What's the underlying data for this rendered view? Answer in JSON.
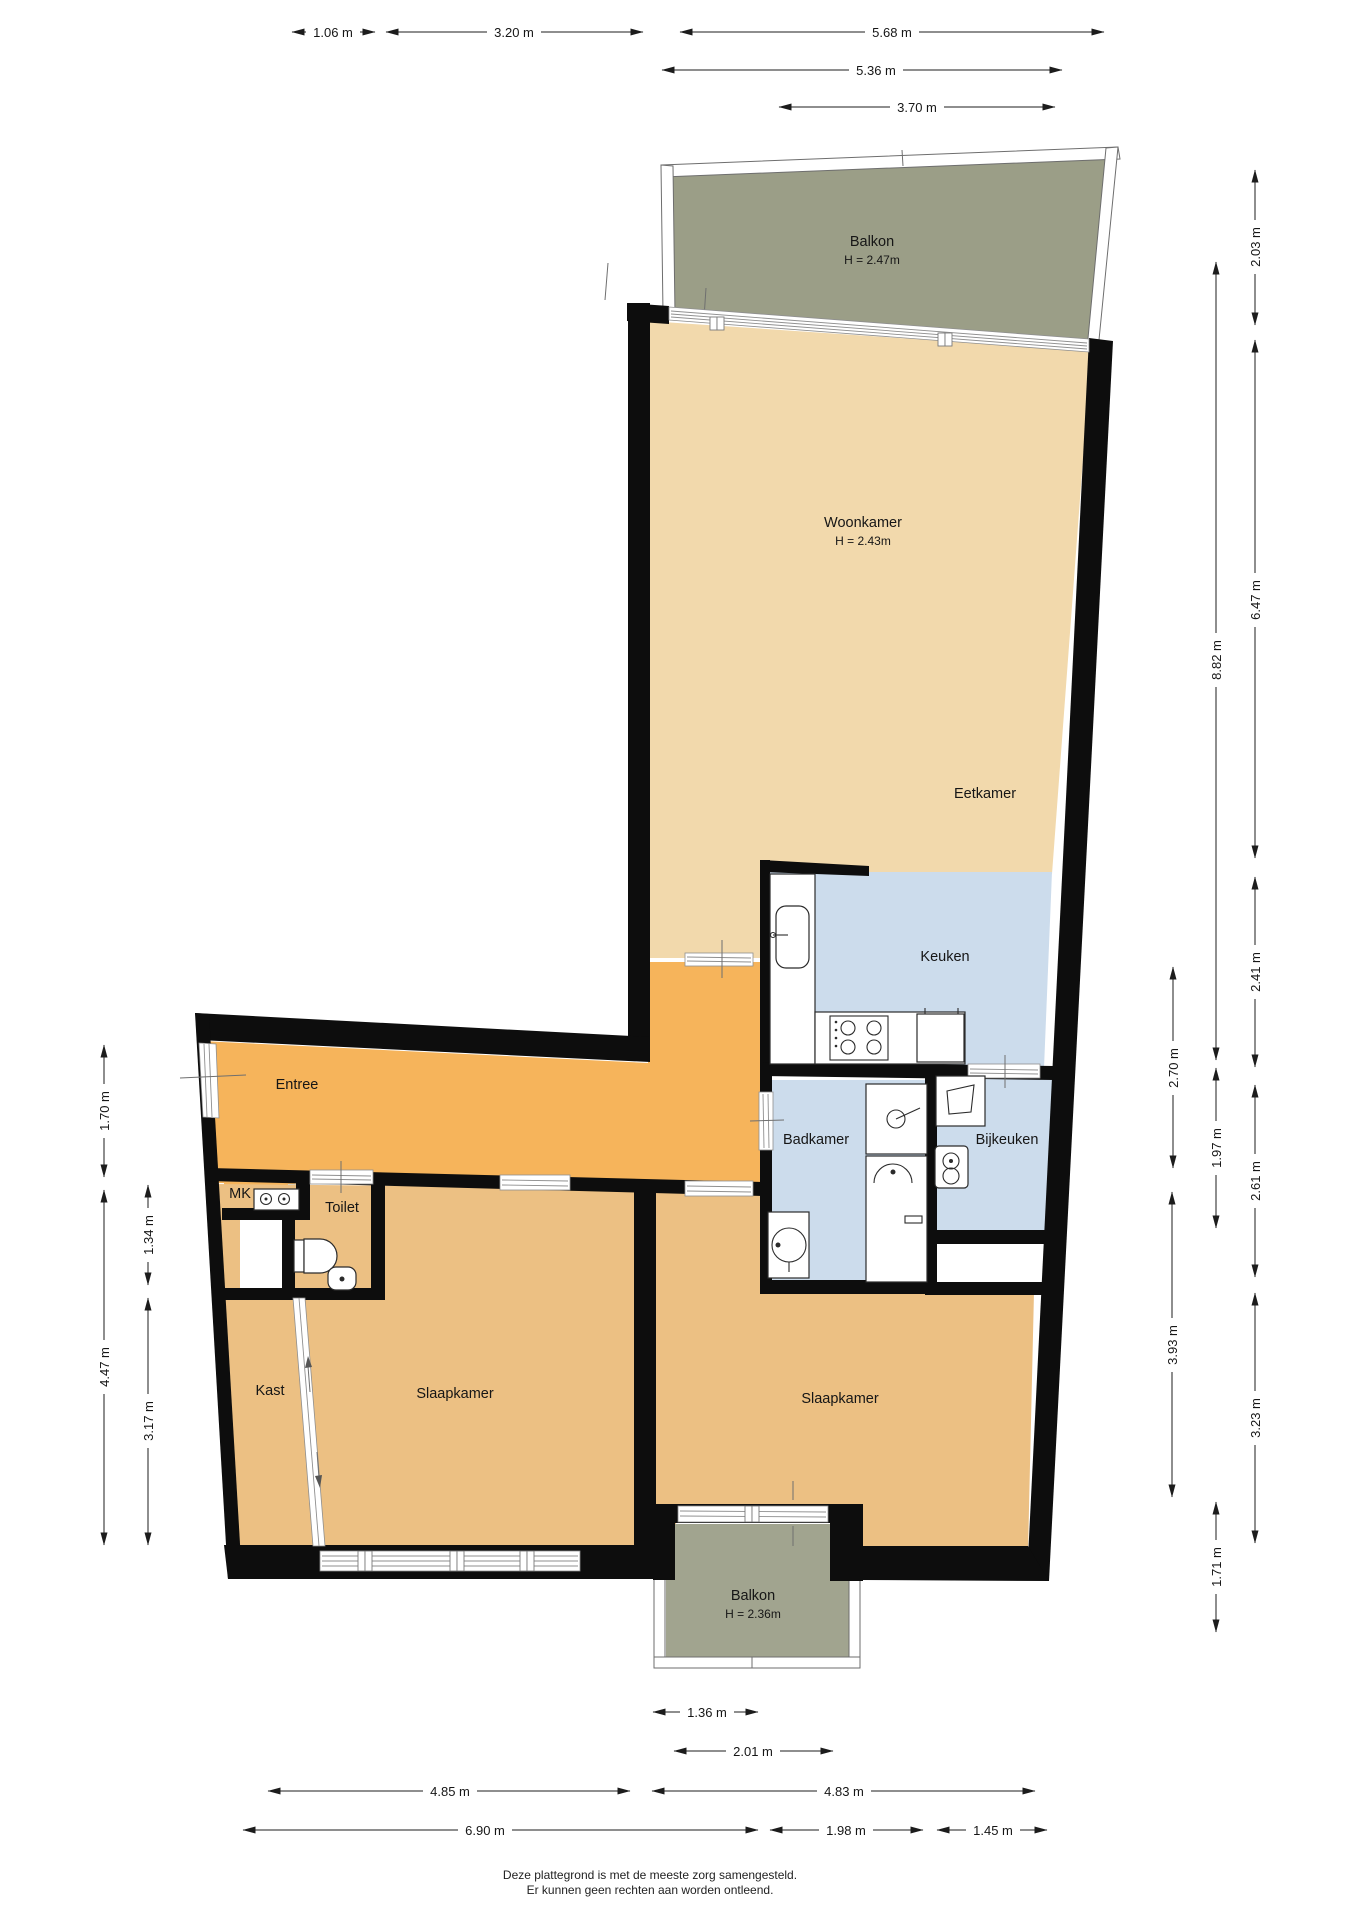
{
  "title": "Plattegrond appartement",
  "colors": {
    "wall": "#0d0d0d",
    "living_floor": "#f2d9ac",
    "hall_floor": "#f6b45b",
    "bedroom_floor": "#ecc083",
    "wet_floor": "#ccdcec",
    "balcony_top": "#9b9e87",
    "balcony_bottom": "#a1a48f"
  },
  "rooms": {
    "balkon_top": {
      "name": "Balkon",
      "height": "H = 2.47m"
    },
    "woonkamer": {
      "name": "Woonkamer",
      "height": "H = 2.43m"
    },
    "eetkamer": {
      "name": "Eetkamer"
    },
    "keuken": {
      "name": "Keuken"
    },
    "entree": {
      "name": "Entree"
    },
    "mk": {
      "name": "MK"
    },
    "toilet": {
      "name": "Toilet"
    },
    "badkamer": {
      "name": "Badkamer"
    },
    "bijkeuken": {
      "name": "Bijkeuken"
    },
    "kast": {
      "name": "Kast"
    },
    "slaapkamer_links": {
      "name": "Slaapkamer"
    },
    "slaapkamer_rechts": {
      "name": "Slaapkamer"
    },
    "balkon_bottom": {
      "name": "Balkon",
      "height": "H = 2.36m"
    }
  },
  "dimensions": {
    "top": [
      "1.06 m",
      "3.20 m",
      "5.68 m",
      "5.36 m",
      "3.70 m"
    ],
    "right": [
      "2.03 m",
      "6.47 m",
      "8.82 m",
      "2.41 m",
      "2.70 m",
      "1.97 m",
      "2.61 m",
      "3.93 m",
      "3.23 m",
      "1.71 m"
    ],
    "left": [
      "1.70 m",
      "1.34 m",
      "4.47 m",
      "3.17 m"
    ],
    "bottom": [
      "1.36 m",
      "2.01 m",
      "4.85 m",
      "4.83 m",
      "6.90 m",
      "1.98 m",
      "1.45 m"
    ]
  },
  "footer": {
    "line1": "Deze plattegrond is met de meeste zorg samengesteld.",
    "line2": "Er kunnen geen rechten aan worden ontleend."
  }
}
